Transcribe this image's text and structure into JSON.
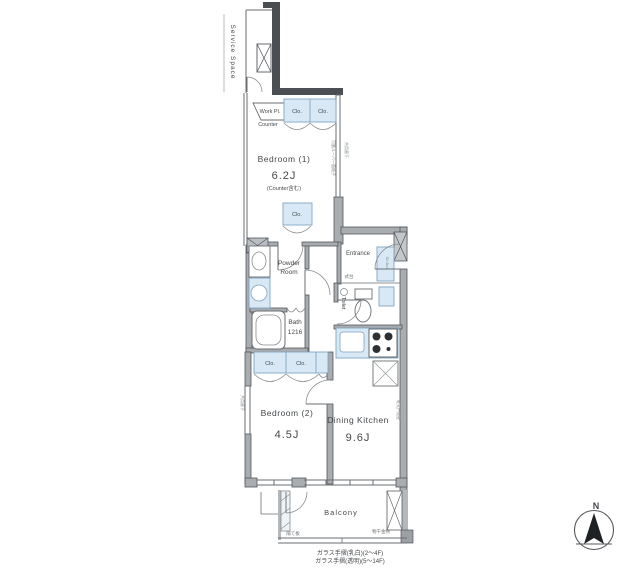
{
  "colors": {
    "fixture_blue": "#d8e9f5",
    "fixture_blue_border": "#7fa3c2",
    "wall_dark": "#4b4e52",
    "wall_gray": "#a9adb0",
    "line_gray": "#6a6e72",
    "text_gray": "#45484b"
  },
  "labels": {
    "service_space": "Service Space",
    "work_place": "Work Pl.",
    "counter": "Counter",
    "closet": "Clo.",
    "bedroom1_name": "Bedroom (1)",
    "bedroom1_size": "6.2J",
    "bedroom1_note": "(Counter含む)",
    "powder_room_line1": "Powder",
    "powder_room_line2": "Room",
    "bath_name": "Bath",
    "bath_size": "1216",
    "entrance": "Entrance",
    "entrance_step": "式台",
    "shoe_box": "Sh.Box",
    "toilet": "Toilet",
    "dining_kitchen_name": "Dining Kitchen",
    "dining_kitchen_size": "9.6J",
    "bedroom2_name": "Bedroom (2)",
    "bedroom2_size": "4.5J",
    "balcony": "Balcony",
    "partition_note": "隔て板",
    "hanger_note": "物干金物",
    "corridor_note": "共用廊下",
    "louver_note": "可動ルーバー面格子",
    "boundary_wall_note": "乾式戸境壁",
    "railing_note_line1": "ガラス手摺(乳白)(2〜4F)",
    "railing_note_line2": "ガラス手摺(透明)(5〜14F)",
    "compass_north": "N"
  }
}
